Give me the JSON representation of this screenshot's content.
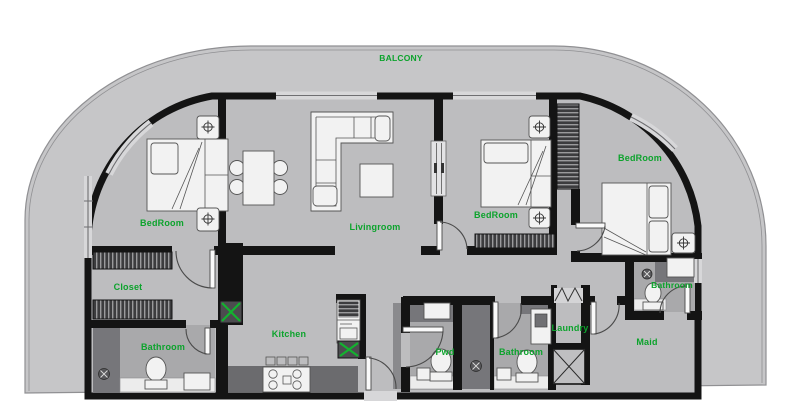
{
  "drawing": {
    "type": "apartment-floor-plan",
    "label_color": "#0ca32c",
    "colors": {
      "balcony_fill": "#c6c6c8",
      "floor_fill": "#bdbdbf",
      "bath_floor": "#a9a9ab",
      "dark_tile": "#76767a",
      "counter_dark": "#6b6b6e",
      "wall": "#141414",
      "railing_line": "#909093"
    },
    "icons": {
      "nightstand-marker-icon": "circle-cross",
      "floor-drain-icon": "dark-circle-x",
      "shaft-x-icon": "box-with-diagonals",
      "duct-marker-icon": "green-x-box"
    }
  },
  "labels": [
    {
      "id": "balcony",
      "text": "BALCONY",
      "x": 401,
      "y": 61,
      "size": 8.5
    },
    {
      "id": "bedroom-left",
      "text": "BedRoom",
      "x": 162,
      "y": 226,
      "size": 9
    },
    {
      "id": "livingroom",
      "text": "Livingroom",
      "x": 375,
      "y": 230,
      "size": 9
    },
    {
      "id": "bedroom-middle",
      "text": "BedRoom",
      "x": 496,
      "y": 218,
      "size": 9
    },
    {
      "id": "bedroom-right",
      "text": "BedRoom",
      "x": 640,
      "y": 161,
      "size": 9
    },
    {
      "id": "closet",
      "text": "Closet",
      "x": 128,
      "y": 290,
      "size": 9
    },
    {
      "id": "bathroom-left",
      "text": "Bathroom",
      "x": 163,
      "y": 350,
      "size": 9
    },
    {
      "id": "kitchen",
      "text": "Kitchen",
      "x": 289,
      "y": 337,
      "size": 9
    },
    {
      "id": "pwd",
      "text": "Pwd",
      "x": 445,
      "y": 355,
      "size": 9
    },
    {
      "id": "bathroom-middle",
      "text": "Bathroom",
      "x": 521,
      "y": 355,
      "size": 9
    },
    {
      "id": "laundry",
      "text": "Laundry",
      "x": 570,
      "y": 331,
      "size": 9
    },
    {
      "id": "maid",
      "text": "Maid",
      "x": 647,
      "y": 345,
      "size": 9
    },
    {
      "id": "bathroom-right",
      "text": "Bathroom",
      "x": 672,
      "y": 288,
      "size": 8.5
    }
  ]
}
